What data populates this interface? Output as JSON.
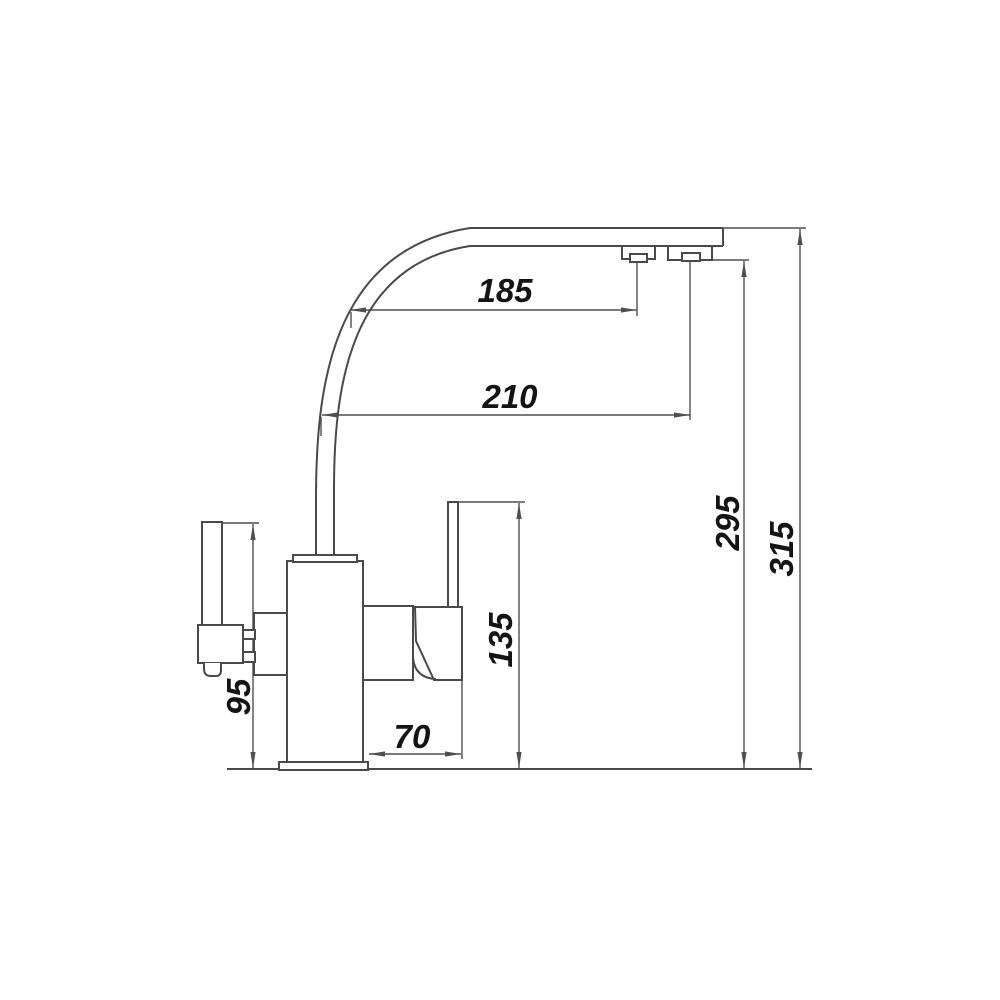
{
  "drawing": {
    "subject": "Kitchen mixer faucet side-view dimensional drawing",
    "background_color": "#ffffff",
    "line_color": "#4a4a4a",
    "text_color": "#141414",
    "dimensions": {
      "spout_reach_filter_outlet": {
        "label": "185",
        "orientation": "horizontal"
      },
      "spout_reach_main_outlet": {
        "label": "210",
        "orientation": "horizontal"
      },
      "outlet_height": {
        "label": "295",
        "orientation": "vertical"
      },
      "overall_height": {
        "label": "315",
        "orientation": "vertical"
      },
      "mixer_handle_height": {
        "label": "135",
        "orientation": "vertical"
      },
      "filter_handle_height": {
        "label": "95",
        "orientation": "vertical"
      },
      "body_to_handle_offset": {
        "label": "70",
        "orientation": "horizontal"
      }
    }
  }
}
